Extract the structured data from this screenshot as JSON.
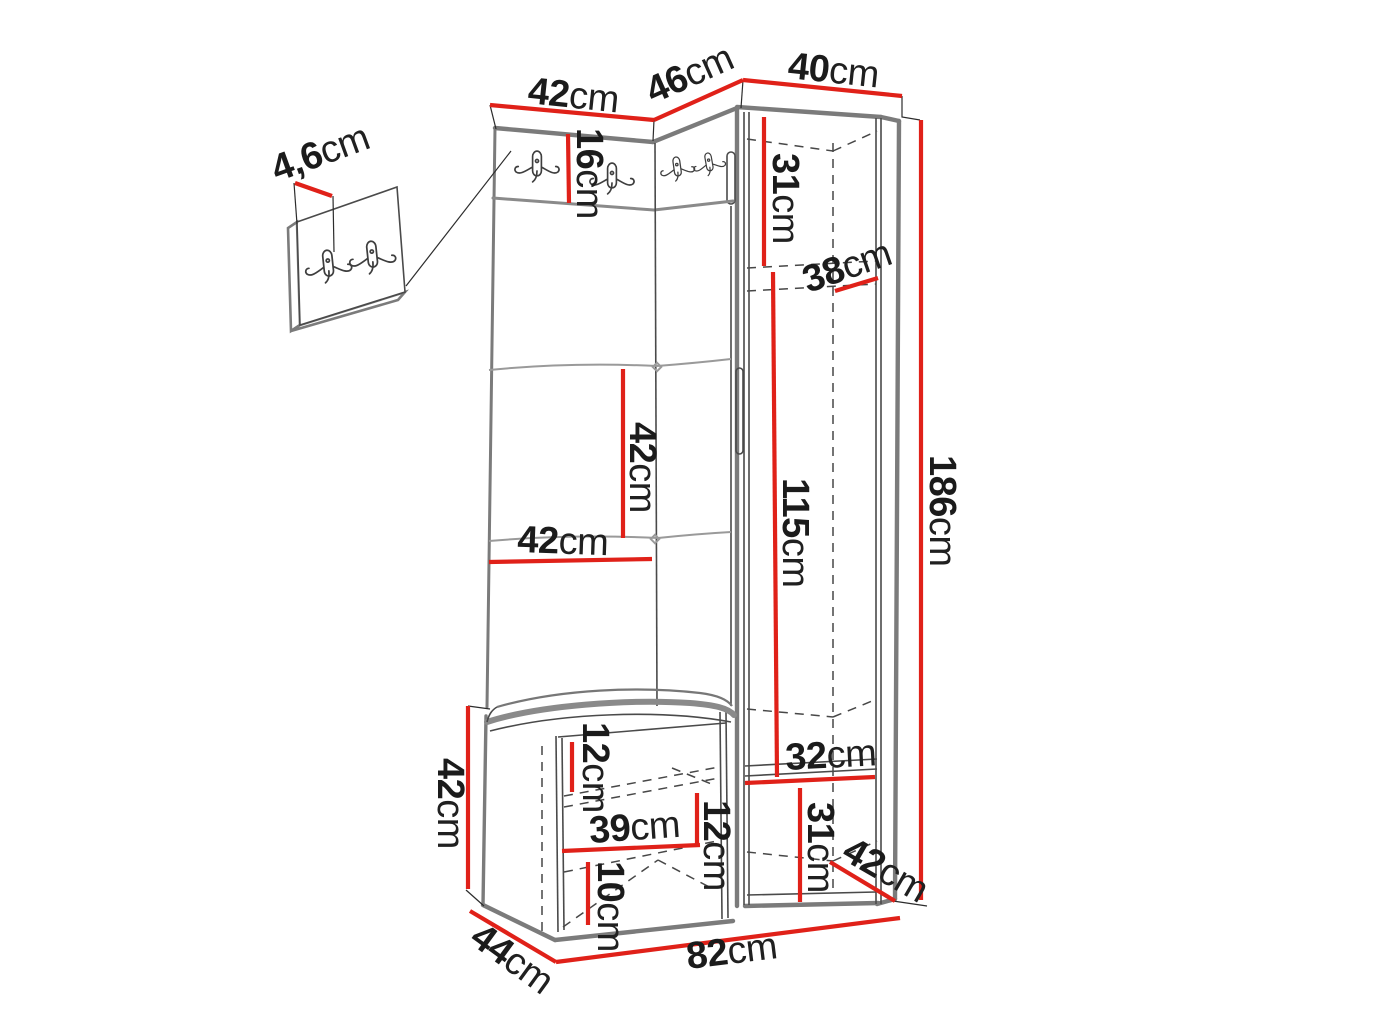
{
  "figure": {
    "type": "furniture_dimension_diagram",
    "subject": "hallway wardrobe set with hook rail, corner bench and tall cabinet",
    "unit": "cm"
  },
  "colors": {
    "dimension_line": "#e02119",
    "outline": "#7b7b7b",
    "detail_line": "#4a4a4a",
    "label_text": "#1b1b1b"
  },
  "hooks": {
    "main_rail_hook_count": 4,
    "detail_panel_hook_count": 2
  },
  "dimensions": [
    {
      "id": "top-left-width",
      "num": "42",
      "suffix": "cm",
      "value": 42,
      "x": 527,
      "y": 103,
      "rot": 6
    },
    {
      "id": "top-angled-width",
      "num": "46",
      "suffix": "cm",
      "value": 46,
      "x": 653,
      "y": 104,
      "rot": -24
    },
    {
      "id": "cabinet-top-width",
      "num": "40",
      "suffix": "cm",
      "value": 40,
      "x": 787,
      "y": 78,
      "rot": 6
    },
    {
      "id": "detail-panel-thickness",
      "num": "4,6",
      "suffix": "cm",
      "value": 4.6,
      "x": 277,
      "y": 182,
      "rot": -20
    },
    {
      "id": "hook-rail-height",
      "num": "16",
      "suffix": "cm",
      "value": 16,
      "x": 577,
      "y": 128,
      "rot": 90
    },
    {
      "id": "cabinet-top-section-height",
      "num": "31",
      "suffix": "cm",
      "value": 31,
      "x": 773,
      "y": 153,
      "rot": 90
    },
    {
      "id": "cabinet-shelf-depth",
      "num": "38",
      "suffix": "cm",
      "value": 38,
      "x": 808,
      "y": 293,
      "rot": -19
    },
    {
      "id": "total-height",
      "num": "186",
      "suffix": "cm",
      "value": 186,
      "x": 930,
      "y": 455,
      "rot": 90
    },
    {
      "id": "panel-square-height",
      "num": "42",
      "suffix": "cm",
      "value": 42,
      "x": 630,
      "y": 422,
      "rot": 90
    },
    {
      "id": "panel-square-width",
      "num": "42",
      "suffix": "cm",
      "value": 42,
      "x": 517,
      "y": 552,
      "rot": 2
    },
    {
      "id": "cabinet-inner-height",
      "num": "115",
      "suffix": "cm",
      "value": 115,
      "x": 783,
      "y": 478,
      "rot": 90
    },
    {
      "id": "bench-seat-offset",
      "num": "12",
      "suffix": "cm",
      "value": 12,
      "x": 583,
      "y": 722,
      "rot": 90
    },
    {
      "id": "bench-height",
      "num": "42",
      "suffix": "cm",
      "value": 42,
      "x": 438,
      "y": 758,
      "rot": 90
    },
    {
      "id": "bench-inner-width",
      "num": "39",
      "suffix": "cm",
      "value": 39,
      "x": 590,
      "y": 843,
      "rot": -4
    },
    {
      "id": "bench-middle-gap",
      "num": "12",
      "suffix": "cm",
      "value": 12,
      "x": 704,
      "y": 800,
      "rot": 90
    },
    {
      "id": "bench-bottom-gap",
      "num": "10",
      "suffix": "cm",
      "value": 10,
      "x": 598,
      "y": 861,
      "rot": 90
    },
    {
      "id": "bench-depth",
      "num": "44",
      "suffix": "cm",
      "value": 44,
      "x": 468,
      "y": 942,
      "rot": 36
    },
    {
      "id": "total-width",
      "num": "82",
      "suffix": "cm",
      "value": 82,
      "x": 688,
      "y": 969,
      "rot": -7
    },
    {
      "id": "compartment-width",
      "num": "32",
      "suffix": "cm",
      "value": 32,
      "x": 786,
      "y": 770,
      "rot": -3
    },
    {
      "id": "compartment-height",
      "num": "31",
      "suffix": "cm",
      "value": 31,
      "x": 808,
      "y": 802,
      "rot": 90
    },
    {
      "id": "cabinet-bottom-depth",
      "num": "42",
      "suffix": "cm",
      "value": 42,
      "x": 840,
      "y": 858,
      "rot": 30
    }
  ]
}
